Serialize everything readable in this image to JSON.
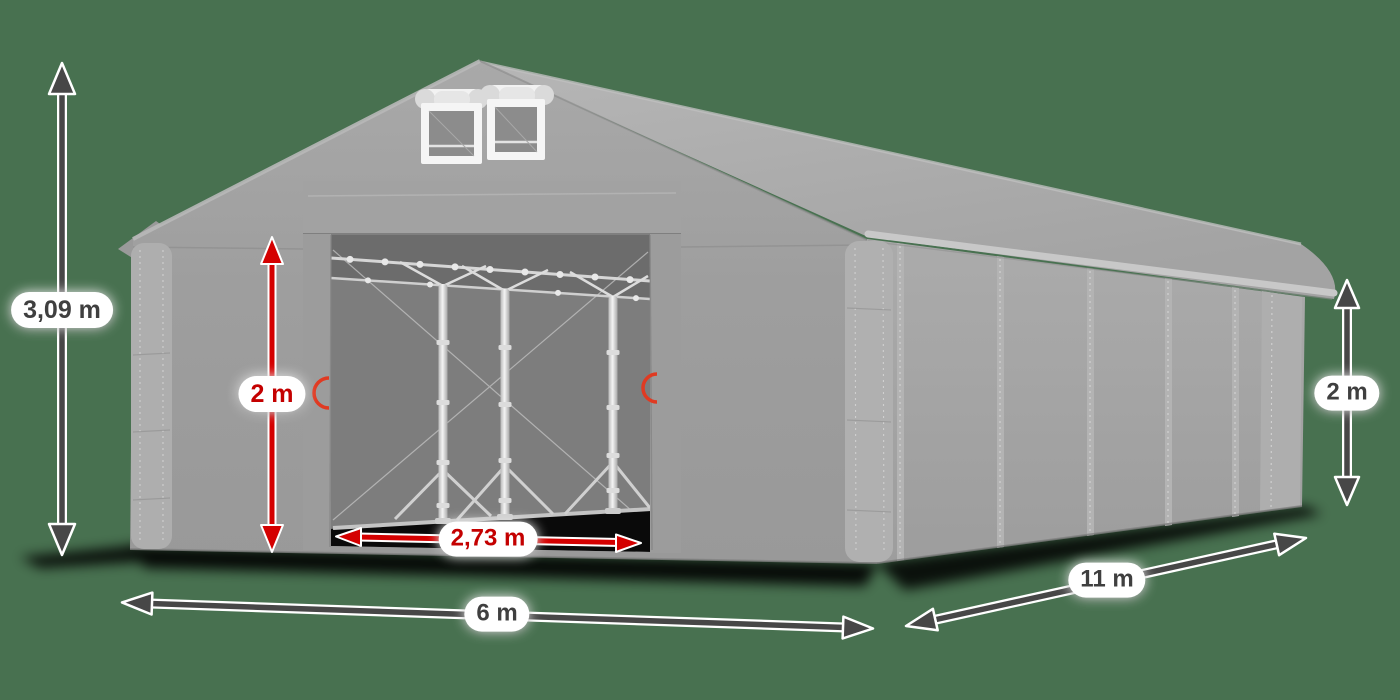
{
  "figure": {
    "background_color": "#487150"
  },
  "annotations": {
    "total_height": {
      "value": "3,09 m",
      "text_color": "#3f3f3f",
      "arrow_color": "#474747",
      "orientation": "vertical",
      "location": "left-of-tent"
    },
    "door_height": {
      "value": "2 m",
      "text_color": "#c40000",
      "arrow_color": "#d40000",
      "orientation": "vertical",
      "location": "front-left-wall"
    },
    "door_width": {
      "value": "2,73 m",
      "text_color": "#c40000",
      "arrow_color": "#d40000",
      "orientation": "horizontal",
      "location": "door-opening"
    },
    "front_width": {
      "value": "6 m",
      "text_color": "#3f3f3f",
      "arrow_color": "#474747",
      "orientation": "horizontal",
      "location": "below-front"
    },
    "side_length": {
      "value": "11 m",
      "text_color": "#3f3f3f",
      "arrow_color": "#474747",
      "orientation": "diagonal",
      "location": "below-right-side"
    },
    "side_wall_height": {
      "value": "2 m",
      "text_color": "#3f3f3f",
      "arrow_color": "#474747",
      "orientation": "vertical",
      "location": "right-of-tent"
    }
  },
  "palette": {
    "roof": "#aeaeae",
    "walls": "#9e9e9e",
    "side_wall": "#a5a5a5",
    "interior": "#7d7d7d",
    "scaffold": "#e8e8e8",
    "floor_shadow": "#0a0a0a",
    "red_accent": "#d40000",
    "dark_arrow": "#474747",
    "label_background": "#ffffff"
  }
}
